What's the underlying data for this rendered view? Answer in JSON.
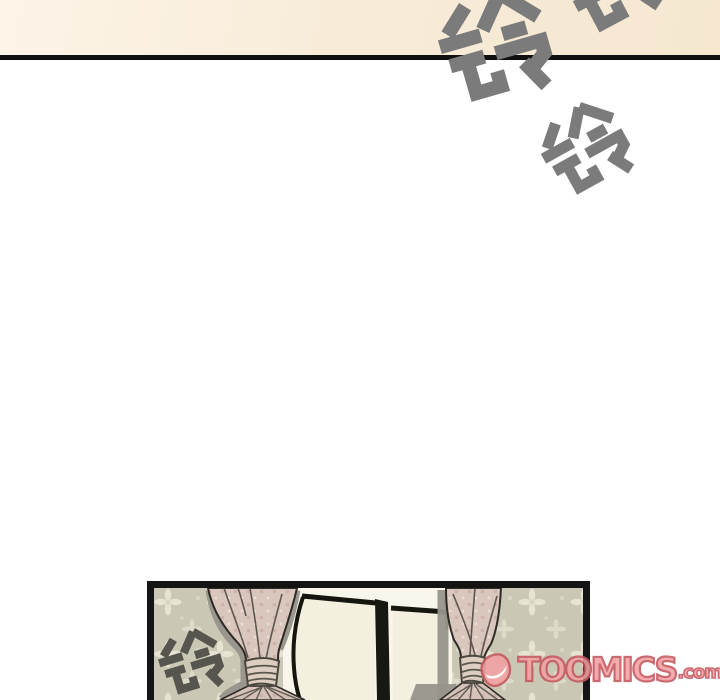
{
  "page": {
    "kind": "webtoon-comic-page"
  },
  "sfx": {
    "text": "铃",
    "meaning": "ring (telephone bell sound effect)",
    "count": 4
  },
  "watermark": {
    "brand": "TOOMICS",
    "suffix": ".com",
    "icon": "smile-d-icon"
  },
  "colors": {
    "paper": "#ffffff",
    "top_band": "#f8ecd9",
    "gutter_ink": "#101010",
    "sfx_gray": "#7b7b7b",
    "panel_sfx_gray": "#57564e",
    "wallpaper": "#cac7b5",
    "curtain": "#d9c6bc",
    "curtain_shadow": "#97948b",
    "window_pane": "#f3f0e0",
    "logo_fill": "#f2a0a2",
    "logo_outline": "#c4575e"
  }
}
